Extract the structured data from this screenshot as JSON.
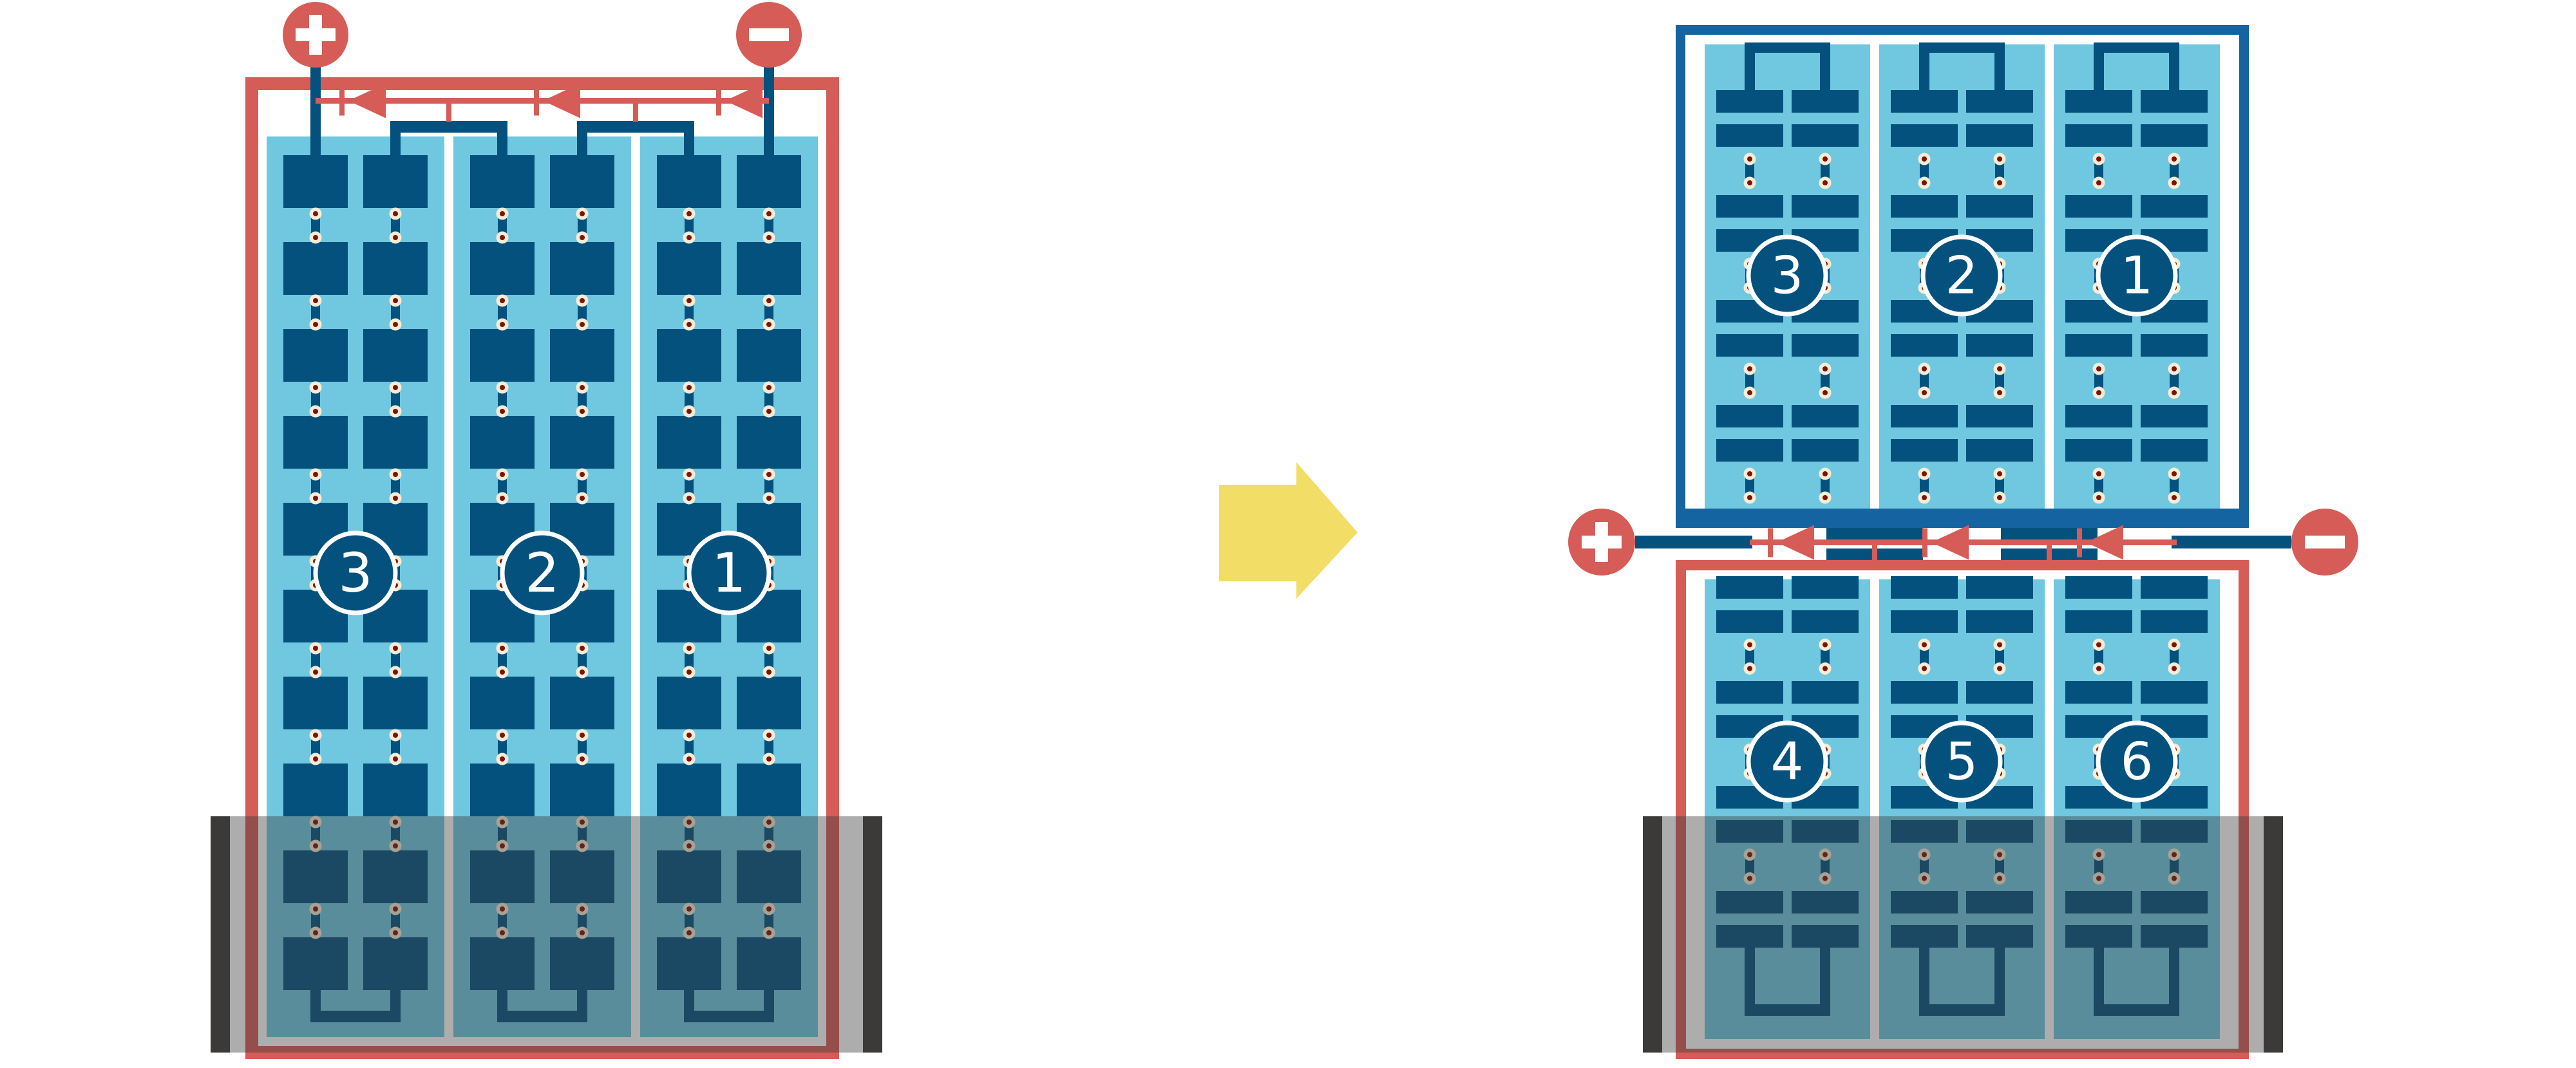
{
  "colors": {
    "case_red": "#D65C57",
    "navy": "#04517E",
    "frame_blue": "#1563A0",
    "light_blue": "#70C8E0",
    "cream": "#F7ECD4",
    "maroon": "#7E120D",
    "white": "#FFFFFF",
    "yellow": "#F2DE67",
    "overlay_gray": "rgba(60,60,60,0.42)",
    "cap_dark": "#3B3A39"
  },
  "left_battery": {
    "terminal_positive": "+",
    "terminal_negative": "−",
    "cells": [
      {
        "label": "3"
      },
      {
        "label": "2"
      },
      {
        "label": "1"
      }
    ]
  },
  "right_battery": {
    "terminal_positive": "+",
    "terminal_negative": "−",
    "top_cells": [
      {
        "label": "3"
      },
      {
        "label": "2"
      },
      {
        "label": "1"
      }
    ],
    "bottom_cells": [
      {
        "label": "4"
      },
      {
        "label": "5"
      },
      {
        "label": "6"
      }
    ]
  }
}
